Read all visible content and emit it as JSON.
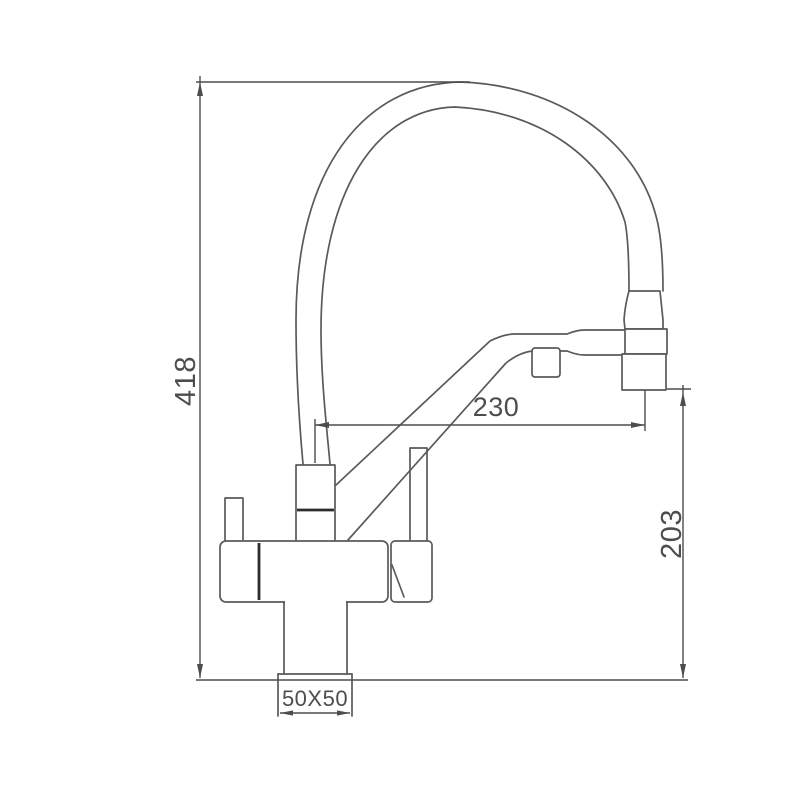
{
  "drawing": {
    "labels": {
      "height_total": "418",
      "spout_reach": "230",
      "spout_height": "203",
      "base_size": "50X50"
    },
    "colors": {
      "line": "#5a5a5a",
      "dimension_line": "#4d4d4d",
      "accent": "#2d2d2d",
      "background": "#ffffff"
    }
  }
}
